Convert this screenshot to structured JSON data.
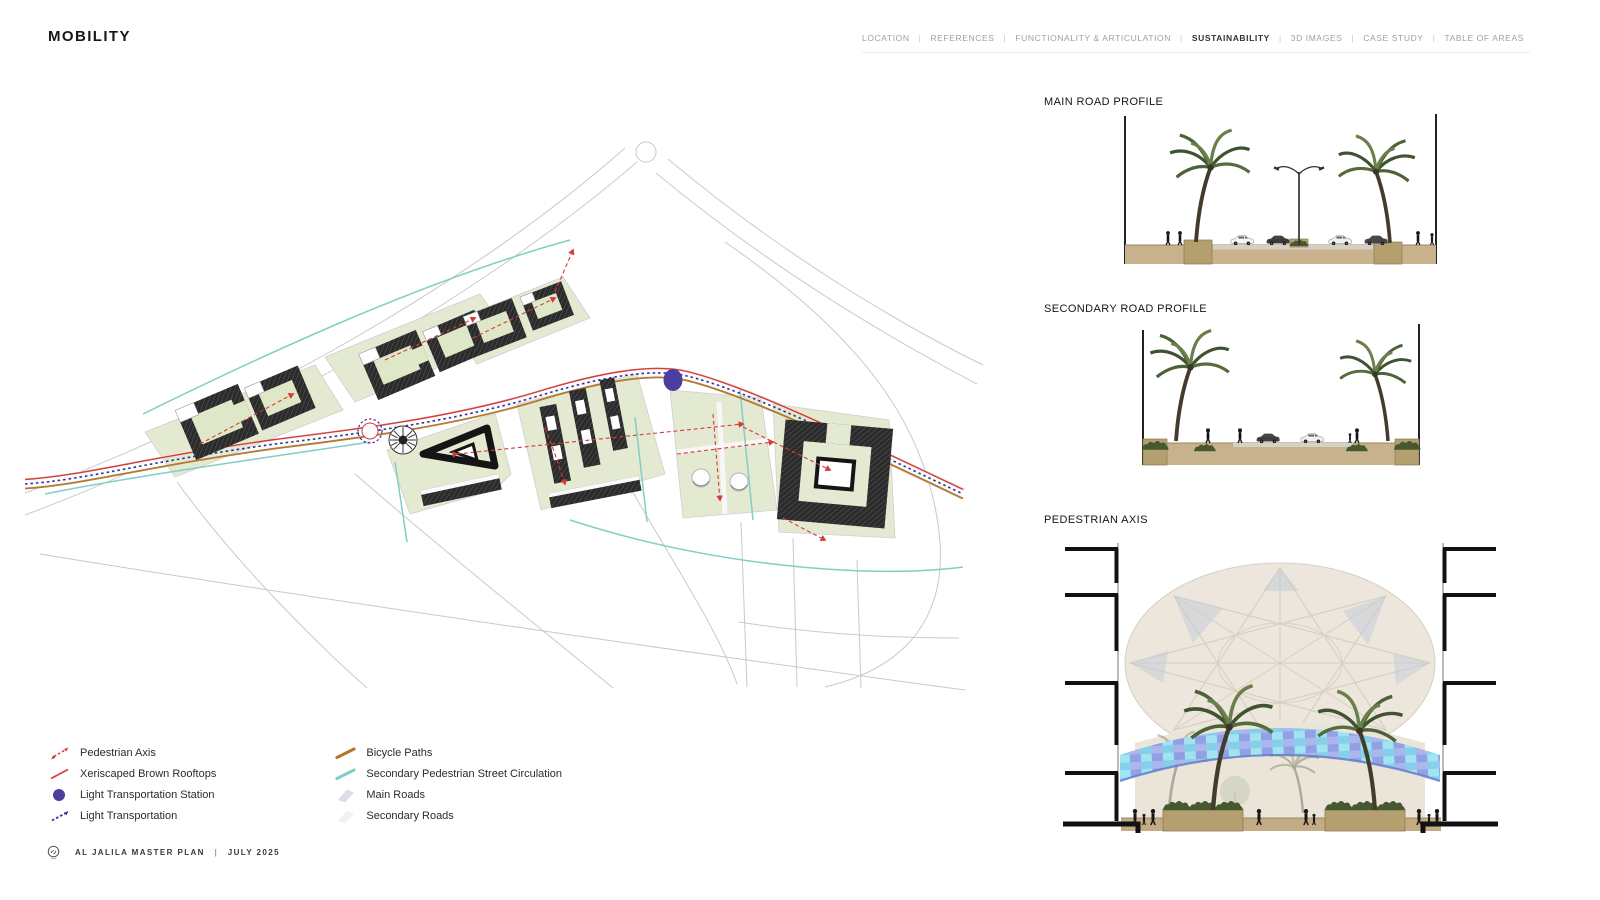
{
  "title": "MOBILITY",
  "nav": {
    "separator": "|",
    "items": [
      {
        "label": "LOCATION",
        "active": false
      },
      {
        "label": "REFERENCES",
        "active": false
      },
      {
        "label": "FUNCTIONALITY & ARTICULATION",
        "active": false
      },
      {
        "label": "SUSTAINABILITY",
        "active": true
      },
      {
        "label": "3D IMAGES",
        "active": false
      },
      {
        "label": "CASE STUDY",
        "active": false
      },
      {
        "label": "TABLE OF AREAS",
        "active": false
      }
    ]
  },
  "legend": {
    "column1": [
      {
        "icon": "pedestrian-axis-icon",
        "label": "Pedestrian Axis"
      },
      {
        "icon": "xeriscaped-rooftops-icon",
        "label": "Xeriscaped Brown Rooftops"
      },
      {
        "icon": "light-transportation-station-icon",
        "label": "Light Transportation Station"
      },
      {
        "icon": "light-transportation-icon",
        "label": "Light Transportation"
      }
    ],
    "column2": [
      {
        "icon": "bicycle-paths-icon",
        "label": "Bicycle Paths"
      },
      {
        "icon": "secondary-pedestrian-circulation-icon",
        "label": "Secondary Pedestrian Street Circulation"
      },
      {
        "icon": "main-roads-icon",
        "label": "Main Roads"
      },
      {
        "icon": "secondary-roads-icon",
        "label": "Secondary Roads"
      }
    ]
  },
  "sections": {
    "main_road": "MAIN ROAD PROFILE",
    "secondary_road": "SECONDARY ROAD PROFILE",
    "pedestrian_axis": "PEDESTRIAN AXIS"
  },
  "footer": {
    "project": "AL JALILA MASTER PLAN",
    "separator": "|",
    "date": "JULY 2025"
  },
  "colors": {
    "pedestrian_axis_red": "#d93a36",
    "light_transportation_blue": "#2d2f9e",
    "station_purple": "#4a3f9f",
    "bicycle_brown": "#b5782f",
    "secondary_teal": "#84cdc6",
    "main_roads_gray": "#dcdde6",
    "secondary_roads_gray": "#f0f0f5",
    "lawn_green": "#e3ead1",
    "ground_tan": "#c8b28e"
  }
}
